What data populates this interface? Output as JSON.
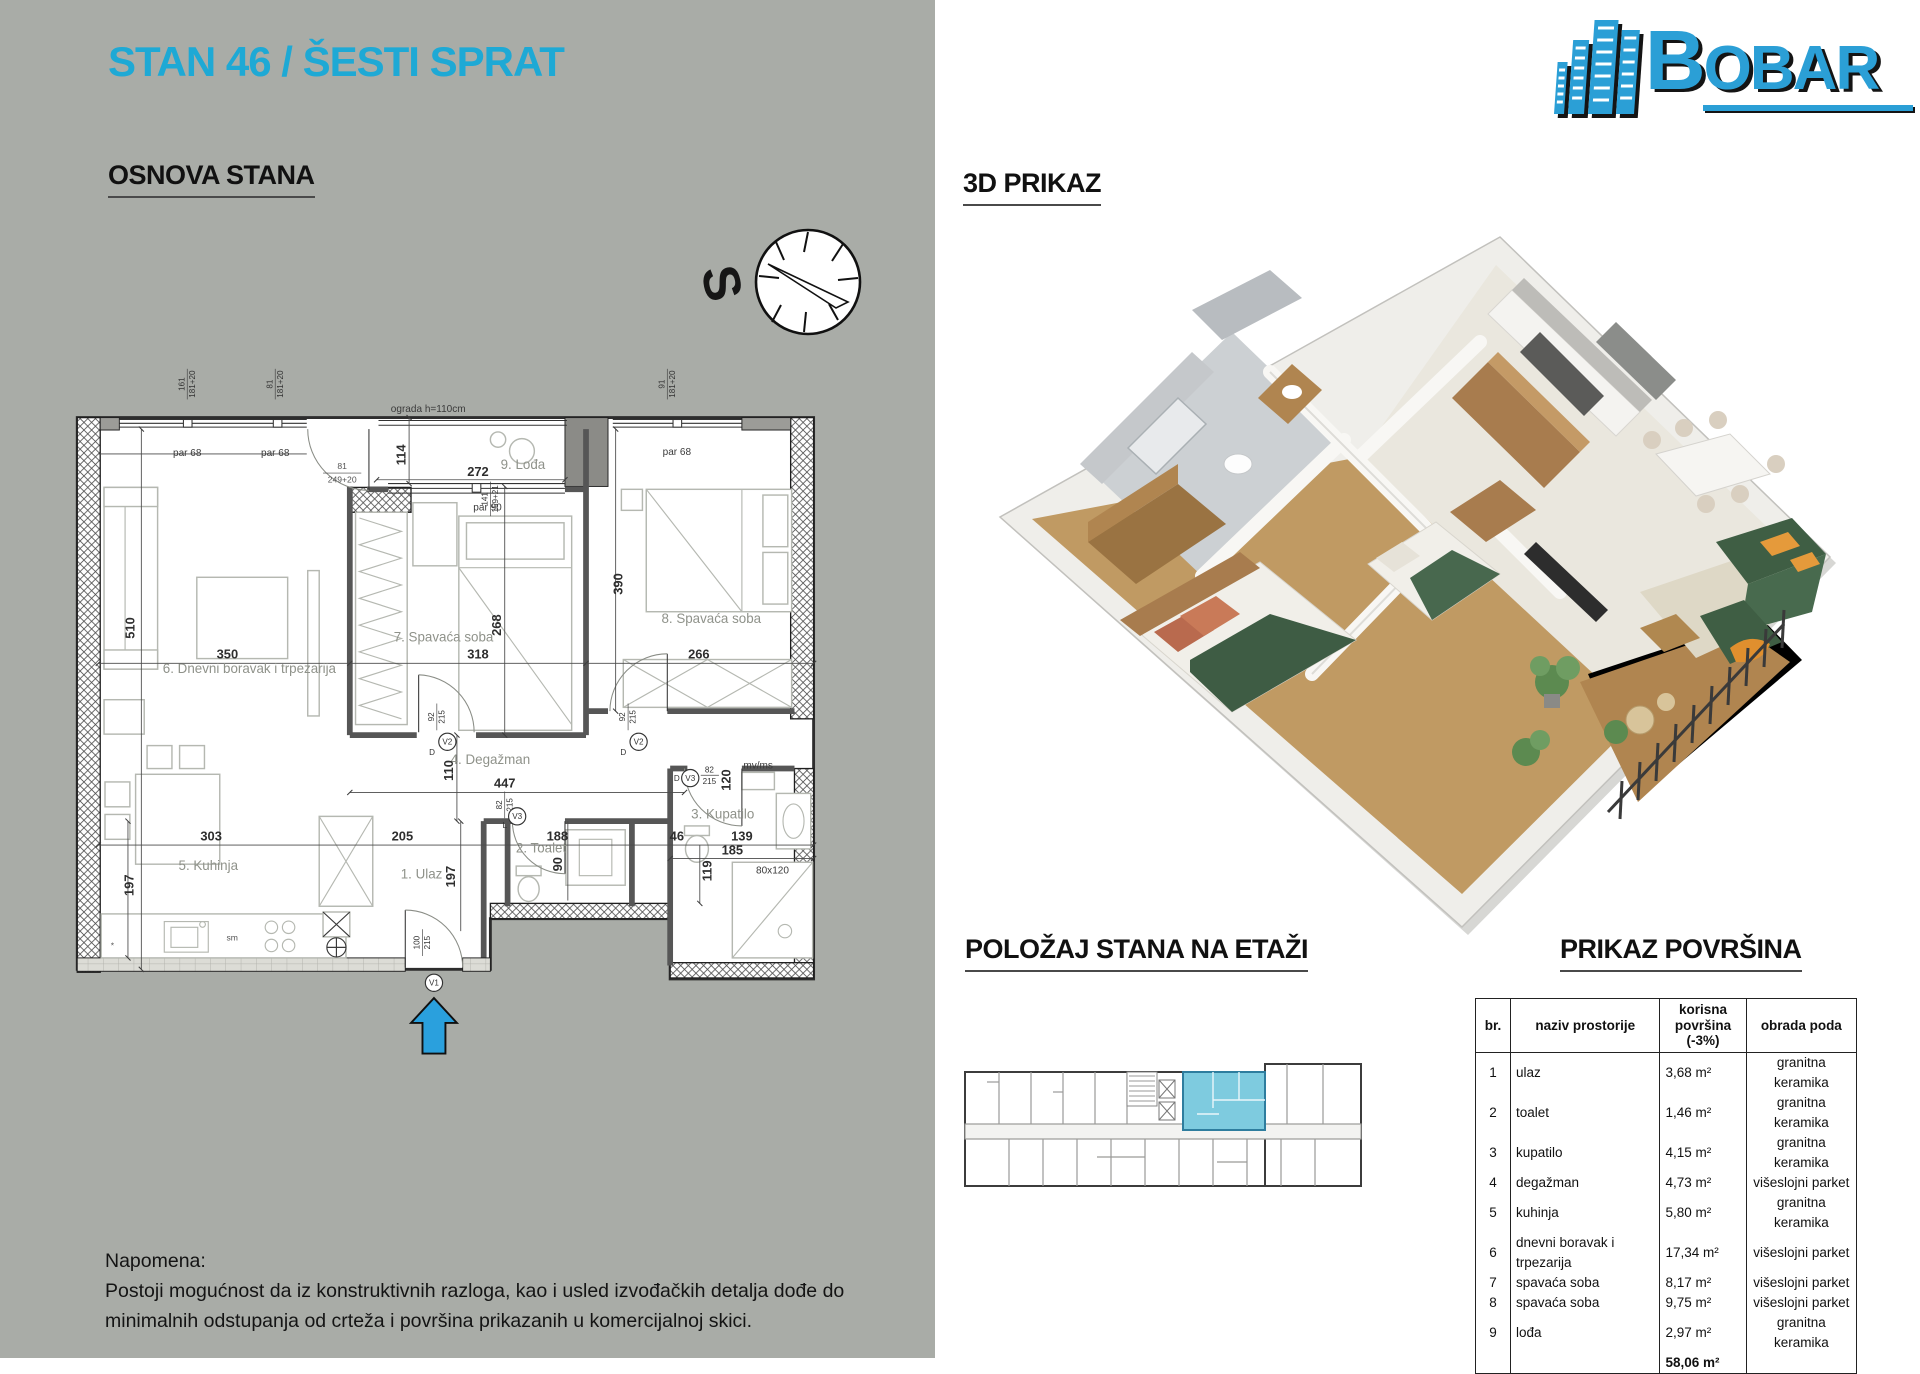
{
  "title": "STAN 46 / ŠESTI SPRAT",
  "headings": {
    "osnova": "OSNOVA STANA",
    "prikaz3d": "3D PRIKAZ",
    "polozaj": "POLOŽAJ STANA NA ETAŽI",
    "povrsine": "PRIKAZ POVRŠINA"
  },
  "logo": {
    "first_letter": "B",
    "rest": "OBAR"
  },
  "compass": {
    "letter": "S"
  },
  "colors": {
    "accent_cyan": "#1ea9d5",
    "page_gray": "#a9aca7",
    "logo_blue": "#2b9fd6",
    "unit_highlight": "#7ecbdf",
    "arrow_blue": "#2aa0dd"
  },
  "floorplan": {
    "rooms": {
      "r1": "1. Ulaz",
      "r2": "2. Toalet",
      "r3": "3. Kupatilo",
      "r4": "4. Degažman",
      "r5": "5. Kuhinja",
      "r6": "6. Dnevni boravak i trpezarija",
      "r7": "7. Spavaća soba",
      "r8": "8. Spavaća soba",
      "r9": "9. Lođa"
    },
    "dims": {
      "d510": "510",
      "d350": "350",
      "d303": "303",
      "d197": "197",
      "d205": "205",
      "d188": "188",
      "d90": "90",
      "d46": "46",
      "d139": "139",
      "d185": "185",
      "d119": "119",
      "d110": "110",
      "d447": "447",
      "d272": "272",
      "d114": "114",
      "d268": "268",
      "d318": "318",
      "d390": "390",
      "d266": "266",
      "d120": "120"
    },
    "windows": {
      "w161": "161",
      "w81": "81",
      "w91": "91",
      "wh": "181+20",
      "balc_top": "81",
      "balc_bot": "249+20",
      "log_top": "141",
      "log_bot": "159+21",
      "par68": "par 68",
      "par90": "par 90",
      "ograda": "ograda h=110cm"
    },
    "doors": {
      "v1": "V1",
      "v2": "V2",
      "v3": "V3",
      "f100": "100",
      "f92": "92",
      "f82": "82",
      "f215": "215",
      "dletter": "D",
      "lletter": "L"
    },
    "misc": {
      "shower": "80x120",
      "mvms": "mv/ms",
      "sm": "sm"
    }
  },
  "table": {
    "headers": [
      "br.",
      "naziv prostorije",
      "korisna površina (-3%)",
      "obrada poda"
    ],
    "rows": [
      [
        "1",
        "ulaz",
        "3,68 m²",
        "granitna keramika"
      ],
      [
        "2",
        "toalet",
        "1,46 m²",
        "granitna keramika"
      ],
      [
        "3",
        "kupatilo",
        "4,15 m²",
        "granitna keramika"
      ],
      [
        "4",
        "degažman",
        "4,73 m²",
        "višeslojni parket"
      ],
      [
        "5",
        "kuhinja",
        "5,80 m²",
        "granitna keramika"
      ],
      [
        "6",
        "dnevni boravak i trpezarija",
        "17,34 m²",
        "višeslojni parket"
      ],
      [
        "7",
        "spavaća soba",
        "8,17 m²",
        "višeslojni parket"
      ],
      [
        "8",
        "spavaća soba",
        "9,75 m²",
        "višeslojni parket"
      ],
      [
        "9",
        "lođa",
        "2,97 m²",
        "granitna keramika"
      ]
    ],
    "total": "58,06 m²"
  },
  "note": {
    "label": "Napomena:",
    "text": "Postoji mogućnost da iz konstruktivnih razloga, kao i usled izvođačkih detalja dođe do minimalnih odstupanja od crteža i površina prikazanih u komercijalnoj skici."
  }
}
